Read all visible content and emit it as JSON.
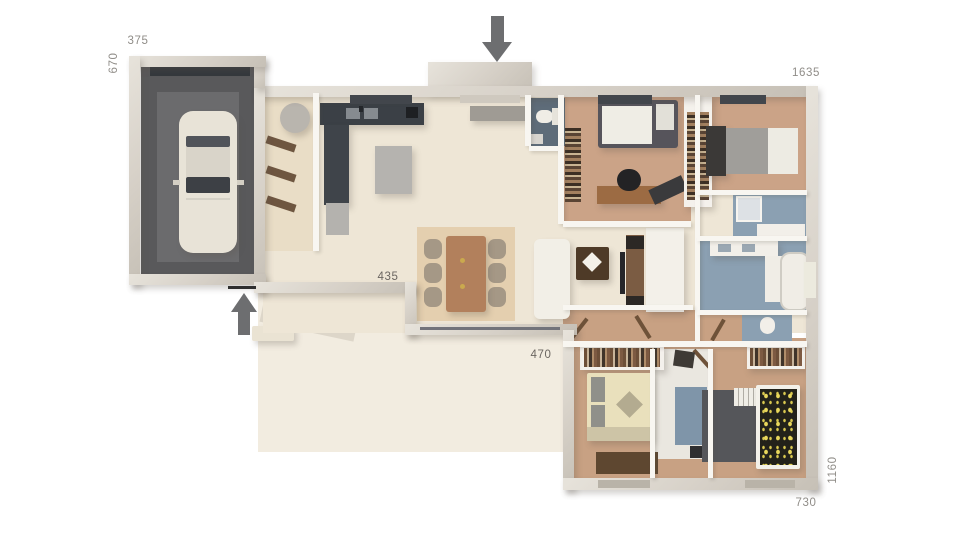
{
  "meta": {
    "title": "3D house floor plan rendering",
    "background": "#ffffff"
  },
  "colors": {
    "wall": "#d6d0c7",
    "interior_floor": "#eee6d6",
    "terrace": "#f2ece0",
    "wood_floor": "#cba387",
    "garage_floor": "#59595b",
    "kitchen_counter": "#3b4046",
    "bath_floor": "#8ba0b2",
    "label_gray": "#908d88",
    "arrow_gray": "#6d6e70"
  },
  "labels": {
    "d375": {
      "text": "375",
      "x": 138,
      "y": 41,
      "rot": 0,
      "dark": false
    },
    "d670": {
      "text": "670",
      "x": 114,
      "y": 63,
      "rot": -90,
      "dark": false
    },
    "d1635": {
      "text": "1635",
      "x": 806,
      "y": 73,
      "rot": 0,
      "dark": false
    },
    "d435": {
      "text": "435",
      "x": 388,
      "y": 277,
      "rot": 0,
      "dark": true
    },
    "d470": {
      "text": "470",
      "x": 541,
      "y": 355,
      "rot": 0,
      "dark": true
    },
    "d730": {
      "text": "730",
      "x": 806,
      "y": 503,
      "rot": 0,
      "dark": false
    },
    "d1160": {
      "text": "1160",
      "x": 833,
      "y": 470,
      "rot": -90,
      "dark": false
    }
  },
  "arrows": {
    "entrance": {
      "x": 482,
      "y": 16,
      "dir": "down",
      "shaft_w": 13,
      "shaft_h": 26
    },
    "side": {
      "x": 231,
      "y": 293,
      "dir": "up",
      "shaft_w": 12,
      "shaft_h": 23
    }
  },
  "scene": [
    {
      "n": "terrace-left",
      "x": 258,
      "y": 288,
      "w": 152,
      "h": 164,
      "c": "#f2ece0"
    },
    {
      "n": "terrace-right",
      "x": 410,
      "y": 333,
      "w": 166,
      "h": 119,
      "c": "#f2ece0"
    },
    {
      "n": "terrace-shadow",
      "x": 262,
      "y": 298,
      "w": 96,
      "h": 34,
      "c": "rgba(130,118,98,0.18)",
      "rot": 12
    },
    {
      "n": "garden-bench",
      "x": 252,
      "y": 326,
      "w": 42,
      "h": 15,
      "c": "#eae3d3",
      "r": 2,
      "sh": true
    },
    {
      "n": "main-floor",
      "x": 263,
      "y": 95,
      "w": 545,
      "h": 238,
      "c": "#eee6d6",
      "cls": "tile"
    },
    {
      "n": "utility-floor",
      "x": 263,
      "y": 95,
      "w": 52,
      "h": 156,
      "c": "#e9ddc6"
    },
    {
      "n": "office-floor",
      "x": 563,
      "y": 95,
      "w": 128,
      "h": 128,
      "c": "#cba387",
      "cls": "wood"
    },
    {
      "n": "bedroom2-floor",
      "x": 697,
      "y": 95,
      "w": 110,
      "h": 98,
      "c": "#cba387",
      "cls": "wood"
    },
    {
      "n": "corridor-floor",
      "x": 563,
      "y": 310,
      "w": 180,
      "h": 35,
      "c": "#c8a183",
      "cls": "wood"
    },
    {
      "n": "wing-floor",
      "x": 570,
      "y": 338,
      "w": 238,
      "h": 141,
      "c": "#c8a183",
      "cls": "wood"
    },
    {
      "n": "garage-floor",
      "x": 141,
      "y": 66,
      "w": 113,
      "h": 209,
      "c": "#59595b"
    },
    {
      "n": "garage-floor-center",
      "x": 157,
      "y": 92,
      "w": 82,
      "h": 170,
      "c": "#6b6b6d"
    },
    {
      "n": "garage-door",
      "x": 150,
      "y": 63,
      "w": 100,
      "h": 13,
      "c": "#34383d"
    },
    {
      "n": "wc-entry-floor",
      "x": 529,
      "y": 98,
      "w": 36,
      "h": 48,
      "c": "#5e6c79"
    },
    {
      "n": "shower-room-floor",
      "x": 733,
      "y": 194,
      "w": 74,
      "h": 44,
      "c": "#8ba0b2"
    },
    {
      "n": "bathroom-floor",
      "x": 699,
      "y": 240,
      "w": 108,
      "h": 71,
      "c": "#8ba0b2"
    },
    {
      "n": "wc2-floor",
      "x": 742,
      "y": 312,
      "w": 50,
      "h": 30,
      "c": "#8ba0b2"
    },
    {
      "n": "shower2-room-floor",
      "x": 655,
      "y": 349,
      "w": 55,
      "h": 110,
      "c": "#eae7e0"
    },
    {
      "n": "shower2-floor",
      "x": 675,
      "y": 387,
      "w": 32,
      "h": 58,
      "c": "#7f95a9"
    },
    {
      "n": "car-body",
      "x": 179,
      "y": 111,
      "w": 58,
      "h": 142,
      "c": "#e8e3d7",
      "r": 14,
      "sh": true
    },
    {
      "n": "car-rear-window",
      "x": 186,
      "y": 136,
      "w": 44,
      "h": 11,
      "c": "#51545a",
      "r": 2
    },
    {
      "n": "car-roof",
      "x": 186,
      "y": 147,
      "w": 44,
      "h": 30,
      "c": "#d9d4c9"
    },
    {
      "n": "car-windshield",
      "x": 186,
      "y": 177,
      "w": 44,
      "h": 16,
      "c": "#3d4045",
      "r": 2
    },
    {
      "n": "car-mirror-left",
      "x": 173,
      "y": 180,
      "w": 7,
      "h": 5,
      "c": "#d4cfc4"
    },
    {
      "n": "car-mirror-right",
      "x": 237,
      "y": 180,
      "w": 7,
      "h": 5,
      "c": "#d4cfc4"
    },
    {
      "n": "car-hood-line",
      "x": 186,
      "y": 198,
      "w": 44,
      "h": 2,
      "c": "rgba(0,0,0,0.08)"
    },
    {
      "n": "dining-rug",
      "x": 417,
      "y": 227,
      "w": 98,
      "h": 94,
      "c": "#e4cfaf",
      "cls": "speckle"
    },
    {
      "n": "dining-chair-1",
      "x": 424,
      "y": 239,
      "w": 18,
      "h": 20,
      "c": "#a59886",
      "r": 7,
      "cls": "chair"
    },
    {
      "n": "dining-chair-2",
      "x": 424,
      "y": 263,
      "w": 18,
      "h": 20,
      "c": "#a59886",
      "r": 7,
      "cls": "chair"
    },
    {
      "n": "dining-chair-3",
      "x": 424,
      "y": 287,
      "w": 18,
      "h": 20,
      "c": "#a59886",
      "r": 7,
      "cls": "chair"
    },
    {
      "n": "dining-chair-4",
      "x": 488,
      "y": 239,
      "w": 18,
      "h": 20,
      "c": "#a59886",
      "r": 7,
      "cls": "chair"
    },
    {
      "n": "dining-chair-5",
      "x": 488,
      "y": 263,
      "w": 18,
      "h": 20,
      "c": "#a59886",
      "r": 7,
      "cls": "chair"
    },
    {
      "n": "dining-chair-6",
      "x": 488,
      "y": 287,
      "w": 18,
      "h": 20,
      "c": "#a59886",
      "r": 7,
      "cls": "chair"
    },
    {
      "n": "dining-table",
      "x": 446,
      "y": 236,
      "w": 40,
      "h": 76,
      "c": "#b2805c",
      "r": 3,
      "sh": true
    },
    {
      "n": "table-candle-1",
      "x": 460,
      "y": 258,
      "w": 5,
      "h": 5,
      "c": "#caa94e",
      "r": 3
    },
    {
      "n": "table-candle-2",
      "x": 460,
      "y": 284,
      "w": 5,
      "h": 5,
      "c": "#caa94e",
      "r": 3
    },
    {
      "n": "sofa",
      "x": 534,
      "y": 239,
      "w": 36,
      "h": 80,
      "c": "#f2efe7",
      "r": 6,
      "sh": true,
      "cls": "sofa"
    },
    {
      "n": "coffee-table",
      "x": 576,
      "y": 247,
      "w": 33,
      "h": 33,
      "c": "#4e3a27",
      "r": 2,
      "sh": true
    },
    {
      "n": "coffee-table-decor",
      "x": 585,
      "y": 255,
      "w": 14,
      "h": 14,
      "c": "#f4f1e9",
      "rot": 45
    },
    {
      "n": "tv-wall-panel",
      "x": 646,
      "y": 228,
      "w": 38,
      "h": 84,
      "c": "#f3f0e9",
      "sh": true
    },
    {
      "n": "tv-console",
      "x": 626,
      "y": 235,
      "w": 18,
      "h": 74,
      "c": "#7b5c43"
    },
    {
      "n": "speaker-top",
      "x": 626,
      "y": 236,
      "w": 18,
      "h": 13,
      "c": "#2c2825"
    },
    {
      "n": "speaker-bottom",
      "x": 626,
      "y": 296,
      "w": 18,
      "h": 13,
      "c": "#2c2825"
    },
    {
      "n": "tv-screen",
      "x": 620,
      "y": 252,
      "w": 5,
      "h": 42,
      "c": "#26262a"
    },
    {
      "n": "kitchen-counter",
      "x": 320,
      "y": 103,
      "w": 104,
      "h": 22,
      "c": "#3b4046",
      "sh": true
    },
    {
      "n": "kitchen-sink-left",
      "x": 346,
      "y": 108,
      "w": 14,
      "h": 11,
      "c": "#868b90"
    },
    {
      "n": "kitchen-sink-right",
      "x": 364,
      "y": 108,
      "w": 14,
      "h": 11,
      "c": "#868b90"
    },
    {
      "n": "kitchen-faucet",
      "x": 359,
      "y": 106,
      "w": 4,
      "h": 6,
      "c": "#23262a"
    },
    {
      "n": "kitchen-appliance",
      "x": 406,
      "y": 107,
      "w": 12,
      "h": 11,
      "c": "#1e2023"
    },
    {
      "n": "kitchen-tower",
      "x": 324,
      "y": 125,
      "w": 25,
      "h": 80,
      "c": "#3f444a",
      "sh": true
    },
    {
      "n": "kitchen-low-cabinet",
      "x": 326,
      "y": 203,
      "w": 23,
      "h": 32,
      "c": "#b4b2ae"
    },
    {
      "n": "kitchen-island",
      "x": 375,
      "y": 146,
      "w": 37,
      "h": 48,
      "c": "#b5b3af",
      "sh": true
    },
    {
      "n": "entry-console",
      "x": 470,
      "y": 106,
      "w": 56,
      "h": 15,
      "c": "#9f9b94",
      "sh": true
    },
    {
      "n": "water-heater",
      "x": 280,
      "y": 103,
      "w": 30,
      "h": 30,
      "c": "#b9b5ae",
      "r": 15,
      "sh": true
    },
    {
      "n": "utility-shelf-1",
      "x": 266,
      "y": 140,
      "w": 30,
      "h": 8,
      "c": "#6e5640",
      "rot": 18
    },
    {
      "n": "utility-shelf-2",
      "x": 266,
      "y": 170,
      "w": 30,
      "h": 8,
      "c": "#6e5640",
      "rot": 18
    },
    {
      "n": "utility-shelf-3",
      "x": 266,
      "y": 200,
      "w": 30,
      "h": 8,
      "c": "#6e5640",
      "rot": 18
    },
    {
      "n": "entry-wc-toilet",
      "x": 536,
      "y": 110,
      "w": 17,
      "h": 13,
      "c": "#f0ede6",
      "r": 7
    },
    {
      "n": "entry-wc-tank",
      "x": 552,
      "y": 108,
      "w": 6,
      "h": 17,
      "c": "#e6e3db"
    },
    {
      "n": "entry-wc-sink",
      "x": 531,
      "y": 134,
      "w": 12,
      "h": 10,
      "c": "#d8d5cf"
    },
    {
      "n": "office-bed-base",
      "x": 598,
      "y": 100,
      "w": 80,
      "h": 48,
      "c": "#56545b",
      "r": 3,
      "sh": true
    },
    {
      "n": "office-bed-duvet",
      "x": 602,
      "y": 106,
      "w": 50,
      "h": 38,
      "c": "#efede5"
    },
    {
      "n": "office-bed-pillow",
      "x": 656,
      "y": 104,
      "w": 18,
      "h": 26,
      "c": "#e2e0d8"
    },
    {
      "n": "office-bookshelf",
      "x": 565,
      "y": 128,
      "w": 16,
      "h": 74,
      "cls": "books"
    },
    {
      "n": "office-desk",
      "x": 597,
      "y": 186,
      "w": 64,
      "h": 18,
      "c": "#9c6b43",
      "sh": true
    },
    {
      "n": "office-chair",
      "x": 617,
      "y": 169,
      "w": 24,
      "h": 22,
      "c": "#232325",
      "r": 12
    },
    {
      "n": "office-mat",
      "x": 650,
      "y": 182,
      "w": 36,
      "h": 16,
      "c": "#3a3a3c",
      "rot": -25
    },
    {
      "n": "closet-divider",
      "x": 684,
      "y": 95,
      "w": 28,
      "h": 112,
      "c": "#f4f1ec",
      "sh": true
    },
    {
      "n": "closet-divider-shelves",
      "x": 687,
      "y": 112,
      "w": 22,
      "h": 88,
      "cls": "books"
    },
    {
      "n": "bed2-headboard",
      "x": 706,
      "y": 126,
      "w": 20,
      "h": 50,
      "c": "#3b3937",
      "sh": true
    },
    {
      "n": "bed2-mattress",
      "x": 726,
      "y": 128,
      "w": 44,
      "h": 46,
      "c": "#a09e9a"
    },
    {
      "n": "bed2-duvet",
      "x": 768,
      "y": 128,
      "w": 30,
      "h": 46,
      "c": "#edebe3"
    },
    {
      "n": "shower1-vanity",
      "x": 757,
      "y": 224,
      "w": 48,
      "h": 13,
      "c": "#f2efe9"
    },
    {
      "n": "shower1-tray",
      "x": 736,
      "y": 196,
      "w": 22,
      "h": 22,
      "c": "#dde1e5",
      "bd": "2px solid #f6f4ef"
    },
    {
      "n": "bath-vanity",
      "x": 710,
      "y": 241,
      "w": 68,
      "h": 15,
      "c": "#f2efe9",
      "sh": true
    },
    {
      "n": "bath-sink-1",
      "x": 718,
      "y": 244,
      "w": 13,
      "h": 8,
      "c": "#9aa7b2"
    },
    {
      "n": "bath-sink-2",
      "x": 742,
      "y": 244,
      "w": 13,
      "h": 8,
      "c": "#9aa7b2"
    },
    {
      "n": "bath-counter",
      "x": 765,
      "y": 256,
      "w": 24,
      "h": 46,
      "c": "#f0ede6"
    },
    {
      "n": "bath-tub",
      "x": 780,
      "y": 252,
      "w": 26,
      "h": 55,
      "c": "#f0ede6",
      "r": 10,
      "bd": "2px solid #cfccc4"
    },
    {
      "n": "wc2-toilet",
      "x": 760,
      "y": 317,
      "w": 15,
      "h": 17,
      "c": "#f2efe9",
      "r": 8
    },
    {
      "n": "door-leaf-1",
      "x": 577,
      "y": 316,
      "w": 4,
      "h": 26,
      "c": "#6e5239",
      "rot": 38
    },
    {
      "n": "door-leaf-2",
      "x": 641,
      "y": 314,
      "w": 4,
      "h": 26,
      "c": "#6e5239",
      "rot": -32
    },
    {
      "n": "door-leaf-3",
      "x": 716,
      "y": 318,
      "w": 4,
      "h": 24,
      "c": "#6e5239",
      "rot": 30
    },
    {
      "n": "door-leaf-4",
      "x": 700,
      "y": 347,
      "w": 4,
      "h": 24,
      "c": "#6e5239",
      "rot": -42
    },
    {
      "n": "wardrobe-bed3",
      "x": 580,
      "y": 344,
      "w": 84,
      "h": 26,
      "c": "#f4f1ec",
      "sh": true
    },
    {
      "n": "wardrobe-bed3-clothes",
      "x": 584,
      "y": 348,
      "w": 76,
      "h": 19,
      "cls": "clothes"
    },
    {
      "n": "bed3-base",
      "x": 587,
      "y": 373,
      "w": 66,
      "h": 68,
      "c": "#e9e0bc",
      "r": 2,
      "sh": true
    },
    {
      "n": "bed3-pillow-1",
      "x": 591,
      "y": 377,
      "w": 14,
      "h": 25,
      "c": "#90908a"
    },
    {
      "n": "bed3-pillow-2",
      "x": 591,
      "y": 405,
      "w": 14,
      "h": 25,
      "c": "#90908a"
    },
    {
      "n": "bed3-diamond-pillow",
      "x": 620,
      "y": 395,
      "w": 19,
      "h": 19,
      "c": "#b3ab90",
      "rot": 45
    },
    {
      "n": "bed3-foot-throw",
      "x": 587,
      "y": 427,
      "w": 66,
      "h": 14,
      "c": "#cdc4a6"
    },
    {
      "n": "bed3-pouf",
      "x": 674,
      "y": 351,
      "w": 20,
      "h": 16,
      "c": "#3e3a35",
      "rot": 8
    },
    {
      "n": "bed3-rug",
      "x": 596,
      "y": 452,
      "w": 62,
      "h": 22,
      "c": "#5e4730"
    },
    {
      "n": "shower2-vanity",
      "x": 690,
      "y": 446,
      "w": 18,
      "h": 12,
      "c": "#2f2f31"
    },
    {
      "n": "wardrobe-bed4",
      "x": 747,
      "y": 344,
      "w": 58,
      "h": 25,
      "c": "#f4f1ec",
      "sh": true
    },
    {
      "n": "wardrobe-bed4-clothes",
      "x": 750,
      "y": 348,
      "w": 52,
      "h": 18,
      "cls": "clothes"
    },
    {
      "n": "bed4-rug",
      "x": 702,
      "y": 390,
      "w": 62,
      "h": 72,
      "c": "#55565a"
    },
    {
      "n": "bed4-ladder-shelf",
      "x": 734,
      "y": 388,
      "w": 26,
      "h": 18,
      "cls": "ladder"
    },
    {
      "n": "bed4-frame",
      "x": 756,
      "y": 385,
      "w": 44,
      "h": 84,
      "c": "#f3f1ea",
      "r": 2,
      "sh": true
    },
    {
      "n": "bed4-duvet",
      "x": 760,
      "y": 389,
      "w": 37,
      "h": 76,
      "cls": "dots"
    },
    {
      "n": "wall-porch",
      "x": 428,
      "y": 62,
      "w": 104,
      "h": 30,
      "cls": "wall"
    },
    {
      "n": "wall-top",
      "x": 254,
      "y": 86,
      "w": 558,
      "h": 11,
      "cls": "wall"
    },
    {
      "n": "wall-left",
      "x": 254,
      "y": 86,
      "w": 11,
      "h": 207,
      "cls": "wall"
    },
    {
      "n": "wall-garage-join",
      "x": 254,
      "y": 56,
      "w": 11,
      "h": 32,
      "cls": "wall"
    },
    {
      "n": "wall-garage-top",
      "x": 129,
      "y": 56,
      "w": 137,
      "h": 11,
      "cls": "wall"
    },
    {
      "n": "wall-garage-left",
      "x": 129,
      "y": 56,
      "w": 11,
      "h": 229,
      "cls": "wall"
    },
    {
      "n": "wall-garage-bottom",
      "x": 129,
      "y": 274,
      "w": 137,
      "h": 11,
      "cls": "wall"
    },
    {
      "n": "wall-south-kitchen",
      "x": 254,
      "y": 282,
      "w": 162,
      "h": 11,
      "cls": "wall"
    },
    {
      "n": "wall-bay-step",
      "x": 405,
      "y": 282,
      "w": 11,
      "h": 53,
      "cls": "wall"
    },
    {
      "n": "wall-bay-south",
      "x": 405,
      "y": 324,
      "w": 172,
      "h": 11,
      "cls": "wall"
    },
    {
      "n": "bay-window-glass",
      "x": 420,
      "y": 327,
      "w": 140,
      "h": 3,
      "c": "#72737a"
    },
    {
      "n": "wall-right",
      "x": 806,
      "y": 86,
      "w": 12,
      "h": 404,
      "cls": "wall"
    },
    {
      "n": "wall-wing-west",
      "x": 563,
      "y": 330,
      "w": 11,
      "h": 160,
      "cls": "wall"
    },
    {
      "n": "wall-wing-bottom",
      "x": 563,
      "y": 478,
      "w": 255,
      "h": 12,
      "cls": "wall"
    },
    {
      "n": "partition-wc-entry-right",
      "x": 558,
      "y": 95,
      "w": 6,
      "h": 51,
      "cls": "part"
    },
    {
      "n": "partition-wc-entry-left",
      "x": 525,
      "y": 95,
      "w": 6,
      "h": 51,
      "cls": "part"
    },
    {
      "n": "partition-wc-entry-south",
      "x": 529,
      "y": 146,
      "w": 35,
      "h": 5,
      "cls": "part"
    },
    {
      "n": "partition-entry-closet",
      "x": 558,
      "y": 146,
      "w": 6,
      "h": 78,
      "cls": "part"
    },
    {
      "n": "partition-office-south",
      "x": 563,
      "y": 221,
      "w": 128,
      "h": 6,
      "cls": "part"
    },
    {
      "n": "partition-spine",
      "x": 695,
      "y": 95,
      "w": 5,
      "h": 250,
      "cls": "part"
    },
    {
      "n": "partition-bed2-south",
      "x": 697,
      "y": 190,
      "w": 110,
      "h": 5,
      "cls": "part"
    },
    {
      "n": "partition-bath-north",
      "x": 697,
      "y": 236,
      "w": 110,
      "h": 5,
      "cls": "part"
    },
    {
      "n": "partition-bath-south",
      "x": 697,
      "y": 310,
      "w": 110,
      "h": 5,
      "cls": "part"
    },
    {
      "n": "partition-corridor-north",
      "x": 563,
      "y": 305,
      "w": 130,
      "h": 5,
      "cls": "part"
    },
    {
      "n": "partition-wing-north",
      "x": 563,
      "y": 341,
      "w": 244,
      "h": 6,
      "cls": "part"
    },
    {
      "n": "partition-shower2-west",
      "x": 650,
      "y": 349,
      "w": 5,
      "h": 129,
      "cls": "part"
    },
    {
      "n": "partition-shower2-east",
      "x": 708,
      "y": 349,
      "w": 5,
      "h": 129,
      "cls": "part"
    },
    {
      "n": "partition-utility",
      "x": 313,
      "y": 93,
      "w": 6,
      "h": 158,
      "cls": "part"
    },
    {
      "n": "window-kitchen",
      "x": 350,
      "y": 95,
      "w": 62,
      "h": 9,
      "c": "#42464c"
    },
    {
      "n": "window-office",
      "x": 598,
      "y": 95,
      "w": 54,
      "h": 9,
      "c": "#42464c"
    },
    {
      "n": "window-bedroom2",
      "x": 720,
      "y": 95,
      "w": 46,
      "h": 9,
      "c": "#42464c"
    },
    {
      "n": "window-bathroom",
      "x": 804,
      "y": 262,
      "w": 12,
      "h": 36,
      "c": "#eceade"
    },
    {
      "n": "window-bed3",
      "x": 598,
      "y": 480,
      "w": 52,
      "h": 8,
      "c": "#b9b3a8"
    },
    {
      "n": "window-bed4",
      "x": 745,
      "y": 480,
      "w": 50,
      "h": 8,
      "c": "#b9b3a8"
    },
    {
      "n": "entry-door-step",
      "x": 460,
      "y": 95,
      "w": 60,
      "h": 8,
      "c": "#cfc9bf"
    },
    {
      "n": "side-door-threshold",
      "x": 228,
      "y": 286,
      "w": 28,
      "h": 3,
      "c": "#2f2f2f"
    }
  ]
}
